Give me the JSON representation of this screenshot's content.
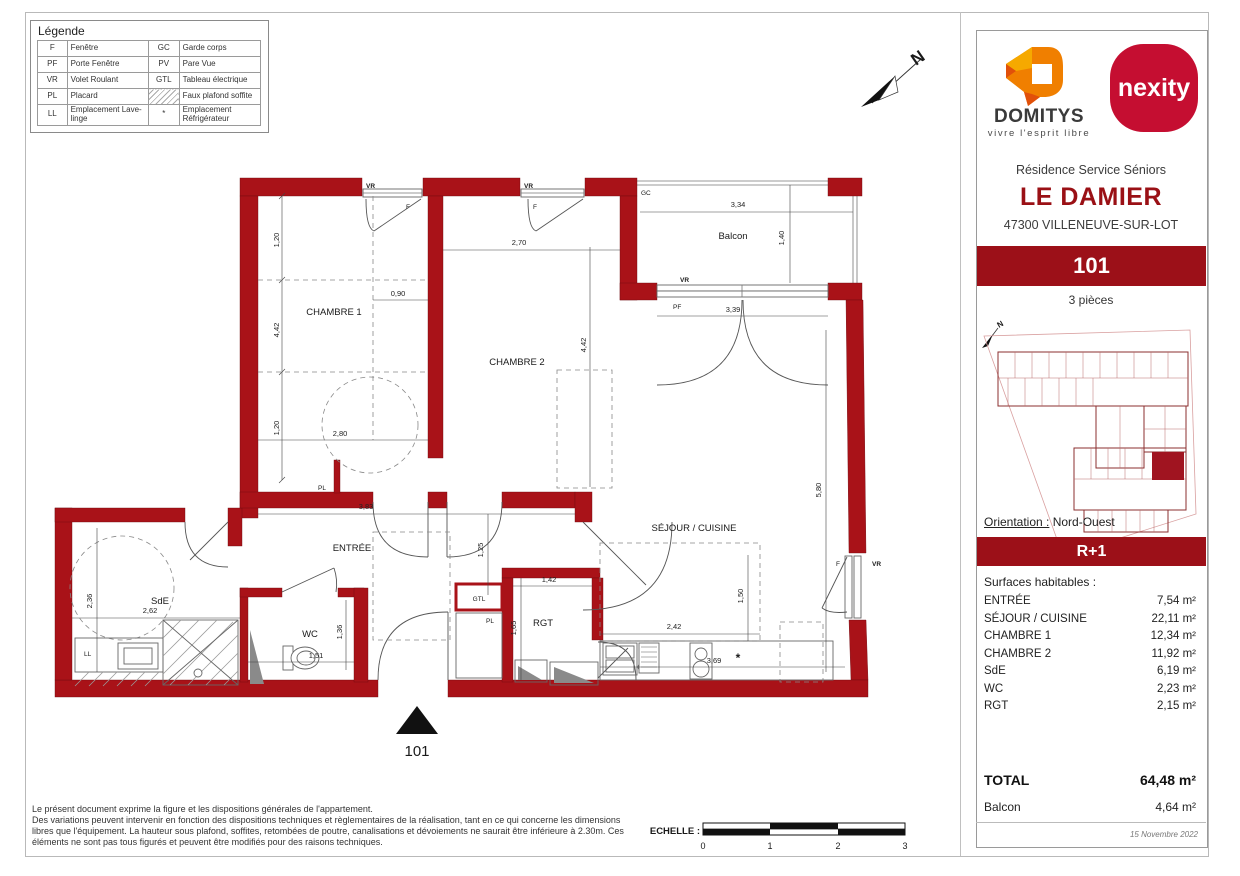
{
  "legend": {
    "title": "Légende",
    "rows": [
      {
        "a": "F",
        "l": "Fenêtre",
        "a2": "GC",
        "l2": "Garde corps"
      },
      {
        "a": "PF",
        "l": "Porte Fenêtre",
        "a2": "PV",
        "l2": "Pare Vue"
      },
      {
        "a": "VR",
        "l": "Volet Roulant",
        "a2": "GTL",
        "l2": "Tableau électrique"
      },
      {
        "a": "PL",
        "l": "Placard",
        "a2": "",
        "l2": "Faux plafond soffite",
        "hatch": true
      },
      {
        "a": "LL",
        "l": "Emplacement Lave-linge",
        "a2": "*",
        "l2": "Emplacement Réfrigérateur"
      }
    ]
  },
  "sidebar": {
    "domitys_name": "DOMITYS",
    "domitys_tagline": "vivre l'esprit libre",
    "nexity_name": "nexity",
    "residence_type": "Résidence Service Séniors",
    "residence_name": "LE DAMIER",
    "residence_address": "47300 VILLENEUVE-SUR-LOT",
    "unit_number": "101",
    "rooms_count": "3 pièces",
    "orientation_label": "Orientation :",
    "orientation_value": "Nord-Ouest",
    "floor": "R+1",
    "surfaces_title": "Surfaces habitables :",
    "surfaces": [
      {
        "name": "ENTRÉE",
        "area": "7,54  m²"
      },
      {
        "name": "SÉJOUR / CUISINE",
        "area": "22,11  m²"
      },
      {
        "name": "CHAMBRE 1",
        "area": "12,34  m²"
      },
      {
        "name": "CHAMBRE 2",
        "area": "11,92  m²"
      },
      {
        "name": "SdE",
        "area": "6,19  m²"
      },
      {
        "name": "WC",
        "area": "2,23  m²"
      },
      {
        "name": "RGT",
        "area": "2,15  m²"
      }
    ],
    "total_label": "TOTAL",
    "total_area": "64,48 m²",
    "balcony_label": "Balcon",
    "balcony_area": "4,64  m²",
    "date": "15 Novembre 2022"
  },
  "plan": {
    "north": "N",
    "unit_marker": "101",
    "rooms": {
      "chambre1": "CHAMBRE 1",
      "chambre2": "CHAMBRE 2",
      "balcon": "Balcon",
      "sejour": "SÉJOUR / CUISINE",
      "entree": "ENTRÉE",
      "sde": "SdE",
      "wc": "WC",
      "rgt": "RGT",
      "gtl": "GTL",
      "ll": "LL",
      "pl": "PL"
    },
    "tags": {
      "vr": "VR",
      "f": "F",
      "pf": "PF",
      "gc": "GC",
      "fridge": "*"
    },
    "dims": {
      "c1_seg_top": "1,20",
      "c1_height": "4,42",
      "c1_seg_bot": "1,20",
      "c1_inner_w": "0,90",
      "c1_width": "2,80",
      "c2_width": "2,70",
      "c2_height": "4,42",
      "balcon_w": "3,34",
      "balcon_d": "1,40",
      "pf_w": "3,39",
      "sejour_h": "5,80",
      "entree_w": "3,83",
      "entree_d": "1,25",
      "sde_h": "2,36",
      "sde_w": "2,62",
      "wc_w": "1,51",
      "wc_h": "1,36",
      "rgt_w": "1,42",
      "rgt_h": "1,65",
      "kitchen_d": "1,50",
      "kitchen_w": "2,42",
      "kitchen_run": "3,69"
    }
  },
  "footer": {
    "lines": [
      "Le présent document exprime la figure et les dispositions générales de l'appartement.",
      "Des variations peuvent intervenir en fonction des dispositions techniques et règlementaires de la réalisation, tant en ce qui concerne les dimensions",
      "libres que l'équipement. La hauteur sous plafond, soffites, retombées de poutre, canalisations et dévoiements ne saurait être inférieure à 2.30m. Ces",
      "éléments ne sont pas tous figurés et peuvent être modifiés pour des raisons techniques."
    ],
    "scale_label": "ECHELLE :",
    "scale_ticks": [
      "0",
      "1",
      "2",
      "3"
    ]
  },
  "colors": {
    "wall_red": "#A91218",
    "banner_red": "#9C1018",
    "title_red": "#9A1015",
    "nexity_red": "#C50E31",
    "domitys_orange": "#F07F00",
    "domitys_yellow": "#F6A900",
    "domitys_deep_orange": "#E1500A"
  }
}
